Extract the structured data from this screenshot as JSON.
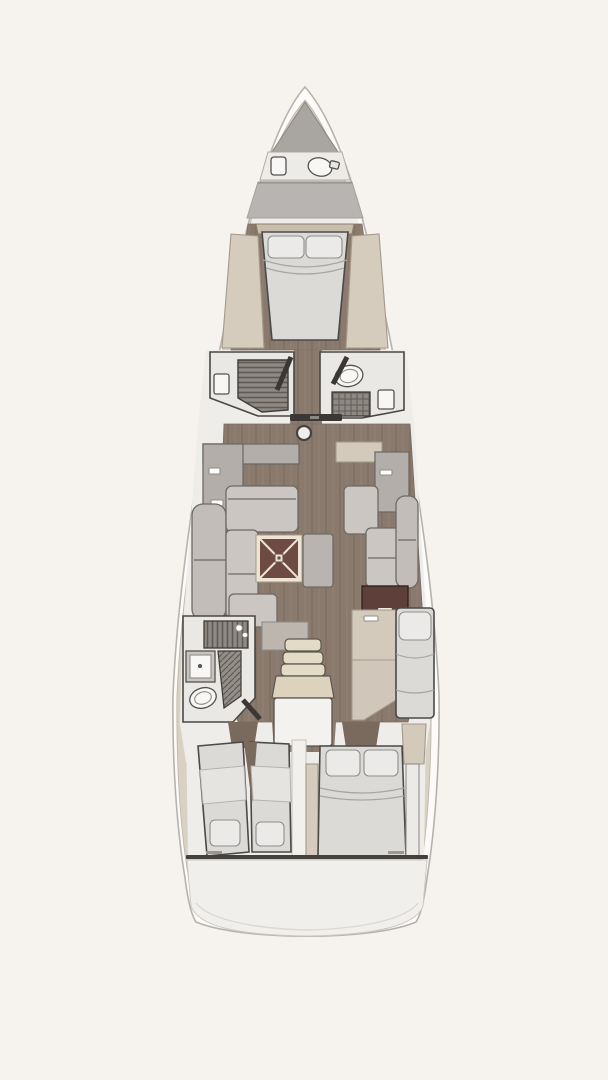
{
  "figure": {
    "kind": "sailing-yacht-interior-deck-plan",
    "orientation": "bow-up",
    "visible_text": "none"
  },
  "palette": {
    "background": "#f6f3ee",
    "hull_fill": "#fcfbf9",
    "hull_stroke": "#b6b2ad",
    "liner": "#d9d1c4",
    "floor_light": "#efedea",
    "wood": "#8a7a6d",
    "wood_dark": "#7a6a5e",
    "bulkhead_gray": "#b7b4b1",
    "locker_gray": "#a9a5a1",
    "counter_gray": "#b3aeaa",
    "cabinet_beige": "#d3cabc",
    "shelf_beige": "#d5ccbd",
    "sofa": "#cbc6c1",
    "sofa_bolster": "#c2bdb8",
    "bed": "#dcdad7",
    "pillow": "#eceae8",
    "blanket": "#e6e4e1",
    "table_top": "#6d4a43",
    "table_trim": "#ede4d4",
    "chart_table": "#5e3f39",
    "grate": "#8e8982",
    "grate_line": "#5f5a55",
    "fixture_white": "#f8f7f5",
    "compartment_floor": "#eae8e5",
    "door_dark": "#3a3734",
    "step_cushion": "#e4dbc6",
    "landing_white": "#f4f2ef",
    "transom": "#f1efec",
    "divider_white": "#f2f0ed",
    "shelf_low": "#bdb6ae"
  },
  "rooms": [
    "anchor-locker",
    "bow-head",
    "forward-owner-cabin",
    "port-shower-room",
    "starboard-head",
    "salon-with-galley",
    "chart-table-area",
    "aft-port-head",
    "companionway",
    "aft-port-cabin-twin-berths",
    "aft-starboard-cabin-double-berth",
    "transom-platform"
  ]
}
